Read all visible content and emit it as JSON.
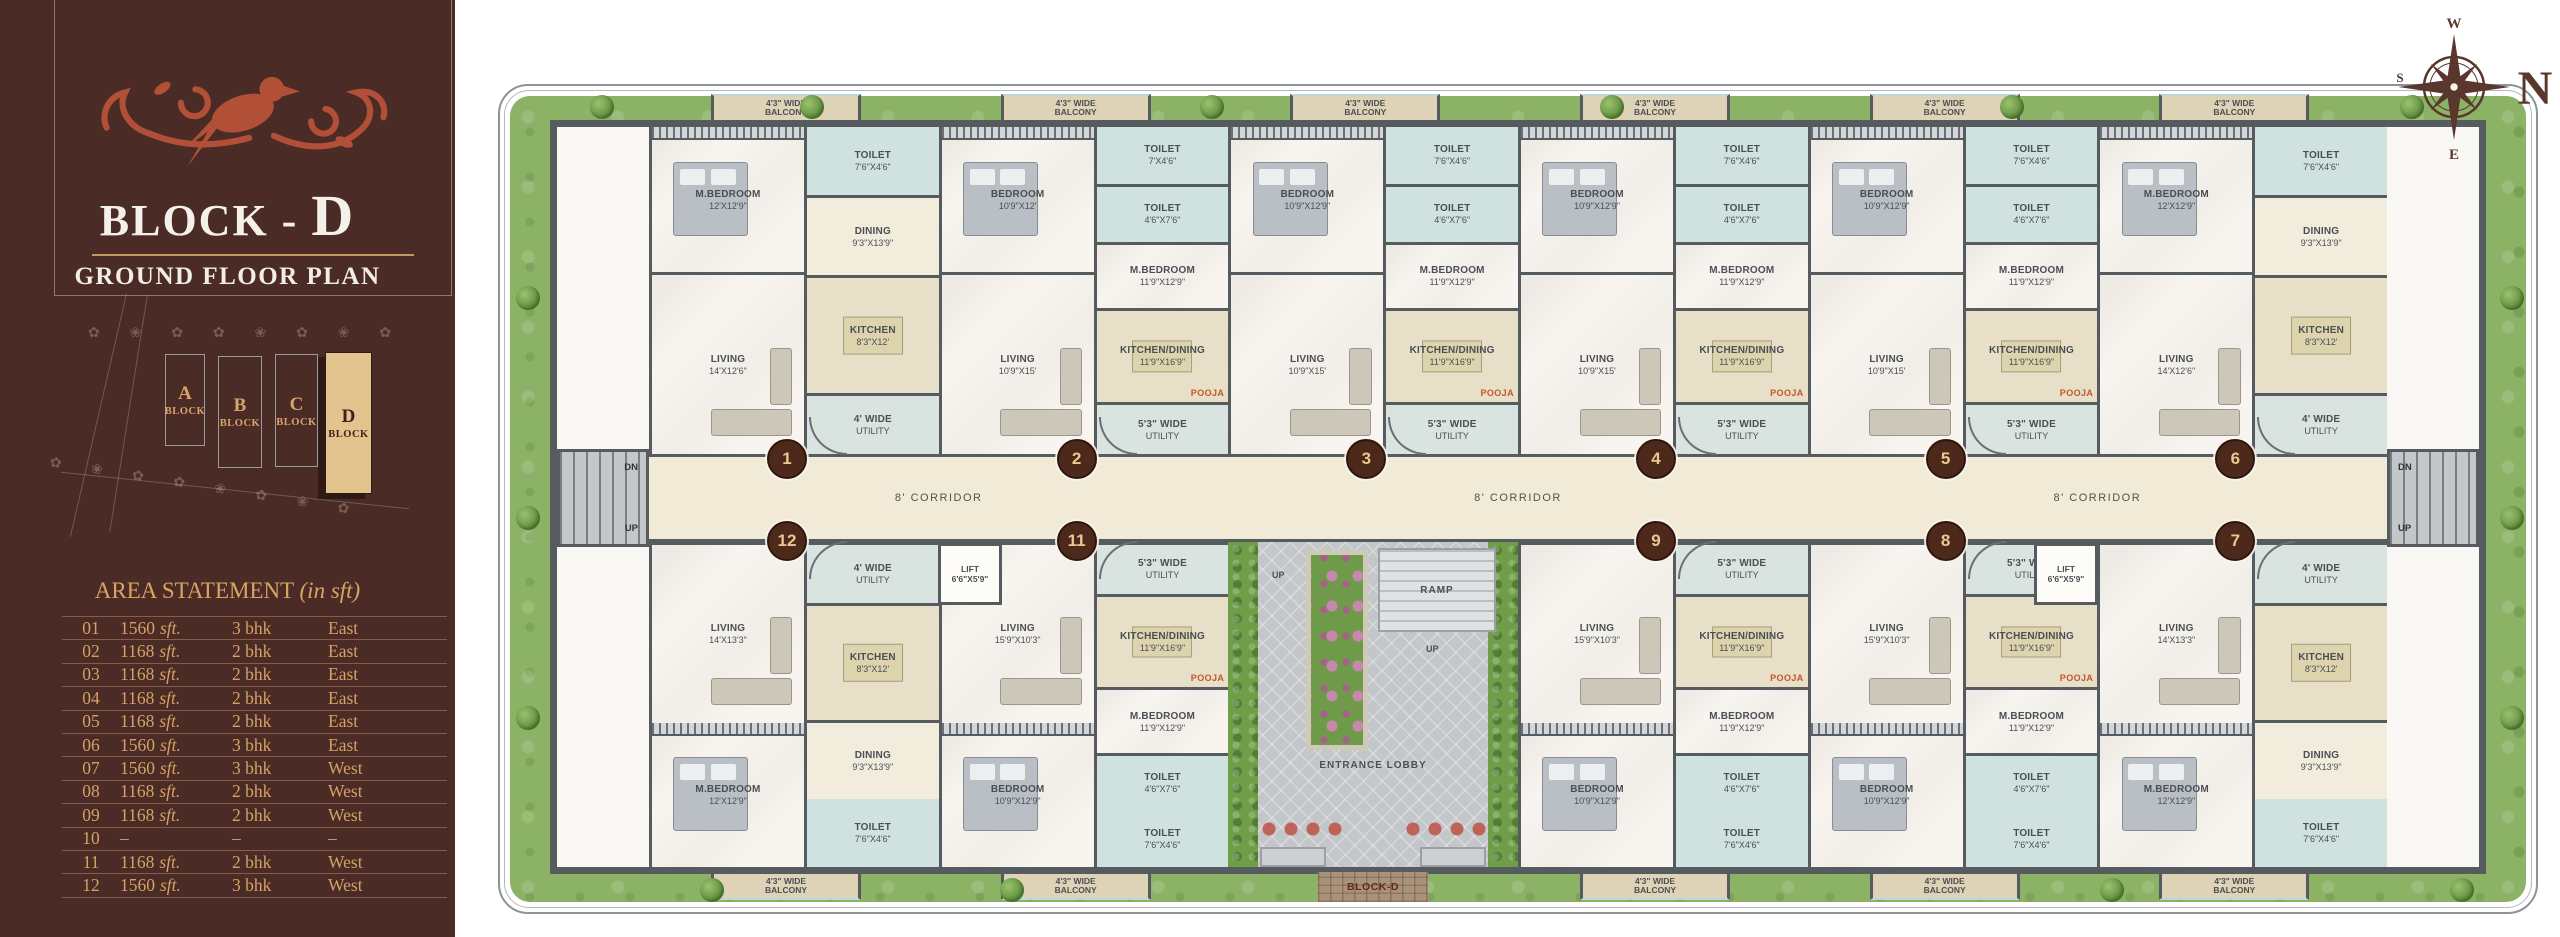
{
  "sidebar": {
    "title_prefix": "BLOCK - ",
    "title_letter": "D",
    "subtitle": "GROUND FLOOR PLAN",
    "site_plan": {
      "decor_row": "✿ ❀ ✿ ✿ ❀ ✿ ❀ ✿",
      "blocks": [
        {
          "letter": "A",
          "label": "BLOCK",
          "active": false
        },
        {
          "letter": "B",
          "label": "BLOCK",
          "active": false
        },
        {
          "letter": "C",
          "label": "BLOCK",
          "active": false
        },
        {
          "letter": "D",
          "label": "BLOCK",
          "active": true
        }
      ]
    },
    "area_statement": {
      "title": "AREA STATEMENT",
      "title_note": "(in sft)",
      "rows": [
        {
          "no": "01",
          "area": "1560",
          "area_unit": "sft.",
          "bhk": "3 bhk",
          "facing": "East"
        },
        {
          "no": "02",
          "area": "1168",
          "area_unit": "sft.",
          "bhk": "2 bhk",
          "facing": "East"
        },
        {
          "no": "03",
          "area": "1168",
          "area_unit": "sft.",
          "bhk": "2 bhk",
          "facing": "East"
        },
        {
          "no": "04",
          "area": "1168",
          "area_unit": "sft.",
          "bhk": "2 bhk",
          "facing": "East"
        },
        {
          "no": "05",
          "area": "1168",
          "area_unit": "sft.",
          "bhk": "2 bhk",
          "facing": "East"
        },
        {
          "no": "06",
          "area": "1560",
          "area_unit": "sft.",
          "bhk": "3 bhk",
          "facing": "East"
        },
        {
          "no": "07",
          "area": "1560",
          "area_unit": "sft.",
          "bhk": "3 bhk",
          "facing": "West"
        },
        {
          "no": "08",
          "area": "1168",
          "area_unit": "sft.",
          "bhk": "2 bhk",
          "facing": "West"
        },
        {
          "no": "09",
          "area": "1168",
          "area_unit": "sft.",
          "bhk": "2 bhk",
          "facing": "West"
        },
        {
          "no": "10",
          "area": "–",
          "area_unit": "",
          "bhk": "–",
          "facing": "–"
        },
        {
          "no": "11",
          "area": "1168",
          "area_unit": "sft.",
          "bhk": "2 bhk",
          "facing": "West"
        },
        {
          "no": "12",
          "area": "1560",
          "area_unit": "sft.",
          "bhk": "3 bhk",
          "facing": "West"
        }
      ]
    }
  },
  "floorplan": {
    "corridor_label": "8' CORRIDOR",
    "stairs": {
      "dn": "DN",
      "up": "UP"
    },
    "lift": {
      "name": "LIFT",
      "dims": "6'6\"X5'9\""
    },
    "courtyard": {
      "entrance": "ENTRANCE LOBBY",
      "ramp": "RAMP",
      "up": "UP",
      "path_label": "BLOCK-D"
    },
    "compass": {
      "n": "N",
      "e": "E",
      "s": "S",
      "w": "W"
    },
    "units": [
      {
        "no": "1",
        "row": "top",
        "slot": 0,
        "rooms": {
          "bedroom": {
            "n": "M.BEDROOM",
            "d": "12'X12'9\""
          },
          "toilet": {
            "n": "TOILET",
            "d": "7'6\"X4'6\""
          },
          "dining": {
            "n": "DINING",
            "d": "9'3\"X13'9\""
          },
          "kitchen": {
            "n": "KITCHEN",
            "d": "8'3\"X12'"
          },
          "living": {
            "n": "LIVING",
            "d": "14'X12'6\""
          },
          "utility": {
            "n": "4' WIDE",
            "d": "UTILITY"
          },
          "balcony": {
            "n": "4'3\" WIDE",
            "d": "BALCONY"
          }
        }
      },
      {
        "no": "2",
        "row": "top",
        "slot": 1,
        "rooms": {
          "bedroom": {
            "n": "BEDROOM",
            "d": "10'9\"X12'"
          },
          "bedroom2": {
            "n": "M.BEDROOM",
            "d": "11'9\"X12'9\""
          },
          "toilet": {
            "n": "TOILET",
            "d": "7'X4'6\""
          },
          "toilet2": {
            "n": "TOILET",
            "d": "4'6\"X7'6\""
          },
          "kitchen": {
            "n": "KITCHEN/DINING",
            "d": "11'9\"X16'9\""
          },
          "living": {
            "n": "LIVING",
            "d": "10'9\"X15'"
          },
          "utility": {
            "n": "5'3\" WIDE",
            "d": "UTILITY"
          },
          "pooja": {
            "n": "POOJA",
            "d": ""
          },
          "balcony": {
            "n": "4'3\" WIDE",
            "d": "BALCONY"
          }
        }
      },
      {
        "no": "3",
        "row": "top",
        "slot": 2,
        "rooms": {
          "bedroom": {
            "n": "BEDROOM",
            "d": "10'9\"X12'9\""
          },
          "bedroom2": {
            "n": "M.BEDROOM",
            "d": "11'9\"X12'9\""
          },
          "toilet": {
            "n": "TOILET",
            "d": "7'6\"X4'6\""
          },
          "toilet2": {
            "n": "TOILET",
            "d": "4'6\"X7'6\""
          },
          "kitchen": {
            "n": "KITCHEN/DINING",
            "d": "11'9\"X16'9\""
          },
          "living": {
            "n": "LIVING",
            "d": "10'9\"X15'"
          },
          "utility": {
            "n": "5'3\" WIDE",
            "d": "UTILITY"
          },
          "pooja": {
            "n": "POOJA",
            "d": ""
          },
          "balcony": {
            "n": "4'3\" WIDE",
            "d": "BALCONY"
          }
        }
      },
      {
        "no": "4",
        "row": "top",
        "slot": 3,
        "rooms": {
          "bedroom": {
            "n": "BEDROOM",
            "d": "10'9\"X12'9\""
          },
          "bedroom2": {
            "n": "M.BEDROOM",
            "d": "11'9\"X12'9\""
          },
          "toilet": {
            "n": "TOILET",
            "d": "7'6\"X4'6\""
          },
          "toilet2": {
            "n": "TOILET",
            "d": "4'6\"X7'6\""
          },
          "kitchen": {
            "n": "KITCHEN/DINING",
            "d": "11'9\"X16'9\""
          },
          "living": {
            "n": "LIVING",
            "d": "10'9\"X15'"
          },
          "utility": {
            "n": "5'3\" WIDE",
            "d": "UTILITY"
          },
          "pooja": {
            "n": "POOJA",
            "d": ""
          },
          "balcony": {
            "n": "4'3\" WIDE",
            "d": "BALCONY"
          }
        }
      },
      {
        "no": "5",
        "row": "top",
        "slot": 4,
        "rooms": {
          "bedroom": {
            "n": "BEDROOM",
            "d": "10'9\"X12'9\""
          },
          "bedroom2": {
            "n": "M.BEDROOM",
            "d": "11'9\"X12'9\""
          },
          "toilet": {
            "n": "TOILET",
            "d": "7'6\"X4'6\""
          },
          "toilet2": {
            "n": "TOILET",
            "d": "4'6\"X7'6\""
          },
          "kitchen": {
            "n": "KITCHEN/DINING",
            "d": "11'9\"X16'9\""
          },
          "living": {
            "n": "LIVING",
            "d": "10'9\"X15'"
          },
          "utility": {
            "n": "5'3\" WIDE",
            "d": "UTILITY"
          },
          "pooja": {
            "n": "POOJA",
            "d": ""
          },
          "balcony": {
            "n": "4'3\" WIDE",
            "d": "BALCONY"
          }
        }
      },
      {
        "no": "6",
        "row": "top",
        "slot": 5,
        "rooms": {
          "bedroom": {
            "n": "M.BEDROOM",
            "d": "12'X12'9\""
          },
          "toilet": {
            "n": "TOILET",
            "d": "7'6\"X4'6\""
          },
          "dining": {
            "n": "DINING",
            "d": "9'3\"X13'9\""
          },
          "kitchen": {
            "n": "KITCHEN",
            "d": "8'3\"X12'"
          },
          "living": {
            "n": "LIVING",
            "d": "14'X12'6\""
          },
          "utility": {
            "n": "4' WIDE",
            "d": "UTILITY"
          },
          "balcony": {
            "n": "4'3\" WIDE",
            "d": "BALCONY"
          }
        }
      },
      {
        "no": "12",
        "row": "bottom",
        "slot": 0,
        "rooms": {
          "bedroom": {
            "n": "M.BEDROOM",
            "d": "12'X12'9\""
          },
          "toilet": {
            "n": "TOILET",
            "d": "7'6\"X4'6\""
          },
          "dining": {
            "n": "DINING",
            "d": "9'3\"X13'9\""
          },
          "kitchen": {
            "n": "KITCHEN",
            "d": "8'3\"X12'"
          },
          "living": {
            "n": "LIVING",
            "d": "14'X13'3\""
          },
          "utility": {
            "n": "4' WIDE",
            "d": "UTILITY"
          },
          "balcony": {
            "n": "4'3\" WIDE",
            "d": "BALCONY"
          }
        }
      },
      {
        "no": "11",
        "row": "bottom",
        "slot": 1,
        "rooms": {
          "bedroom": {
            "n": "BEDROOM",
            "d": "10'9\"X12'9\""
          },
          "bedroom2": {
            "n": "M.BEDROOM",
            "d": "11'9\"X12'9\""
          },
          "toilet": {
            "n": "TOILET",
            "d": "7'6\"X4'6\""
          },
          "toilet2": {
            "n": "TOILET",
            "d": "4'6\"X7'6\""
          },
          "kitchen": {
            "n": "KITCHEN/DINING",
            "d": "11'9\"X16'9\""
          },
          "living": {
            "n": "LIVING",
            "d": "15'9\"X10'3\""
          },
          "utility": {
            "n": "5'3\" WIDE",
            "d": "UTILITY"
          },
          "pooja": {
            "n": "POOJA",
            "d": ""
          },
          "balcony": {
            "n": "4'3\" WIDE",
            "d": "BALCONY"
          }
        }
      },
      {
        "no": "9",
        "row": "bottom",
        "slot": 3,
        "rooms": {
          "bedroom": {
            "n": "BEDROOM",
            "d": "10'9\"X12'9\""
          },
          "bedroom2": {
            "n": "M.BEDROOM",
            "d": "11'9\"X12'9\""
          },
          "toilet": {
            "n": "TOILET",
            "d": "7'6\"X4'6\""
          },
          "toilet2": {
            "n": "TOILET",
            "d": "4'6\"X7'6\""
          },
          "kitchen": {
            "n": "KITCHEN/DINING",
            "d": "11'9\"X16'9\""
          },
          "living": {
            "n": "LIVING",
            "d": "15'9\"X10'3\""
          },
          "utility": {
            "n": "5'3\" WIDE",
            "d": "UTILITY"
          },
          "pooja": {
            "n": "POOJA",
            "d": ""
          },
          "balcony": {
            "n": "4'3\" WIDE",
            "d": "BALCONY"
          }
        }
      },
      {
        "no": "8",
        "row": "bottom",
        "slot": 4,
        "rooms": {
          "bedroom": {
            "n": "BEDROOM",
            "d": "10'9\"X12'9\""
          },
          "bedroom2": {
            "n": "M.BEDROOM",
            "d": "11'9\"X12'9\""
          },
          "toilet": {
            "n": "TOILET",
            "d": "7'6\"X4'6\""
          },
          "toilet2": {
            "n": "TOILET",
            "d": "4'6\"X7'6\""
          },
          "kitchen": {
            "n": "KITCHEN/DINING",
            "d": "11'9\"X16'9\""
          },
          "living": {
            "n": "LIVING",
            "d": "15'9\"X10'3\""
          },
          "utility": {
            "n": "5'3\" WIDE",
            "d": "UTILITY"
          },
          "pooja": {
            "n": "POOJA",
            "d": ""
          },
          "balcony": {
            "n": "4'3\" WIDE",
            "d": "BALCONY"
          }
        }
      },
      {
        "no": "7",
        "row": "bottom",
        "slot": 5,
        "rooms": {
          "bedroom": {
            "n": "M.BEDROOM",
            "d": "12'X12'9\""
          },
          "toilet": {
            "n": "TOILET",
            "d": "7'6\"X4'6\""
          },
          "dining": {
            "n": "DINING",
            "d": "9'3\"X13'9\""
          },
          "kitchen": {
            "n": "KITCHEN",
            "d": "8'3\"X12'"
          },
          "living": {
            "n": "LIVING",
            "d": "14'X13'3\""
          },
          "utility": {
            "n": "4' WIDE",
            "d": "UTILITY"
          },
          "balcony": {
            "n": "4'3\" WIDE",
            "d": "BALCONY"
          }
        }
      }
    ]
  }
}
